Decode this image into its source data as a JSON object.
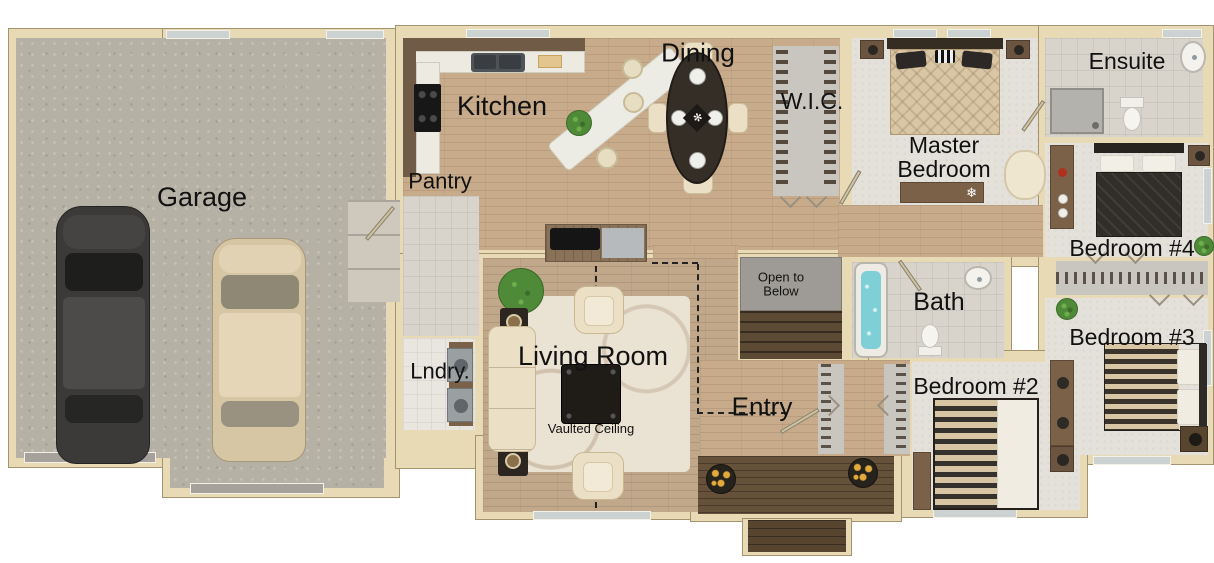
{
  "rooms": {
    "garage": "Garage",
    "kitchen": "Kitchen",
    "pantry": "Pantry",
    "dining": "Dining",
    "wic": "W.I.C.",
    "master_bedroom": "Master Bedroom",
    "ensuite": "Ensuite",
    "bedroom4": "Bedroom #4",
    "bedroom3": "Bedroom #3",
    "bedroom2": "Bedroom #2",
    "bath": "Bath",
    "living_room": "Living Room",
    "laundry": "Lndry.",
    "entry": "Entry"
  },
  "annotations": {
    "open_to_below": "Open to Below",
    "vaulted_ceiling": "Vaulted Ceiling"
  },
  "colors": {
    "wall": "#e9dab6",
    "wall_edge": "#a3946f",
    "wood": "#c7ab8b",
    "wood_living": "#c1a88b",
    "carpet": "#e4e1db",
    "concrete": "#b6b1a5",
    "tile": "#d8d4cb",
    "porch_wood": "#66513a",
    "tub_water": "#7fd0d6",
    "flower_yellow": "#e2a93b",
    "plant_green": "#4e8a38",
    "dark_table": "#352e26",
    "cream_fabric": "#ebe0c6",
    "label_text": "#111111"
  }
}
